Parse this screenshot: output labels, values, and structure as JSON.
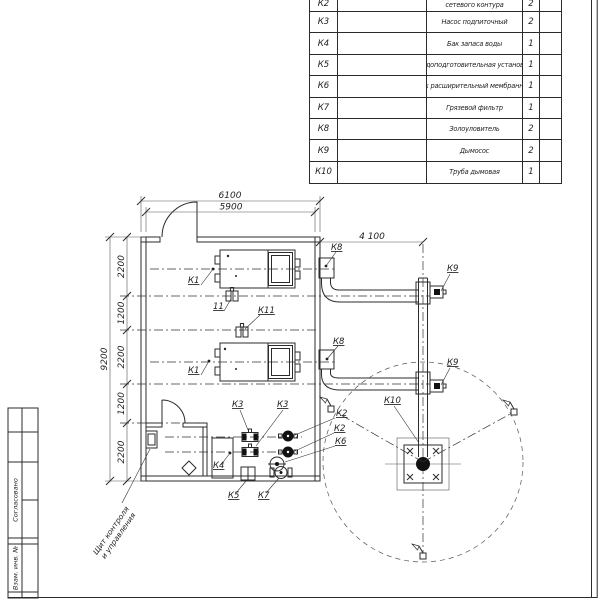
{
  "drawing": {
    "equipment_table": {
      "rows": [
        {
          "pos": "К2",
          "name": "сетевого контура",
          "qty": "2"
        },
        {
          "pos": "К3",
          "name": "Насос подпиточный",
          "qty": "2"
        },
        {
          "pos": "К4",
          "name": "Бак запаса воды",
          "qty": "1"
        },
        {
          "pos": "К5",
          "name": "Водоподготовительная установка",
          "qty": "1"
        },
        {
          "pos": "К6",
          "name": "Бак расширительный мембранный",
          "qty": "1"
        },
        {
          "pos": "К7",
          "name": "Грязевой фильтр",
          "qty": "1"
        },
        {
          "pos": "К8",
          "name": "Золоуловитель",
          "qty": "2"
        },
        {
          "pos": "К9",
          "name": "Дымосос",
          "qty": "2"
        },
        {
          "pos": "К10",
          "name": "Труба дымовая",
          "qty": "1"
        }
      ]
    },
    "dims": {
      "outer_width": "6100",
      "inner_width": "5900",
      "flue_offset": "4 100",
      "overall_height": "9200",
      "seg1": "2200",
      "seg2": "1200",
      "seg3": "2200",
      "seg4": "1200",
      "seg5": "2200"
    },
    "labels": {
      "k1": "К1",
      "k2": "К2",
      "k3": "К3",
      "k4": "К4",
      "k5": "К5",
      "k6": "К6",
      "k7": "К7",
      "k8": "К8",
      "k9": "К9",
      "k10": "К10",
      "k11": "К11",
      "v11": "11"
    },
    "annotations": {
      "panel_note_line1": "Щит контроля",
      "panel_note_line2": "и управления"
    },
    "stamp": {
      "agreed": "Согласовано",
      "replacement": "Взам. инв. №"
    }
  },
  "colors": {
    "line": "#2b2b2b",
    "hatch": "#8a8a8a",
    "background": "#ffffff"
  }
}
